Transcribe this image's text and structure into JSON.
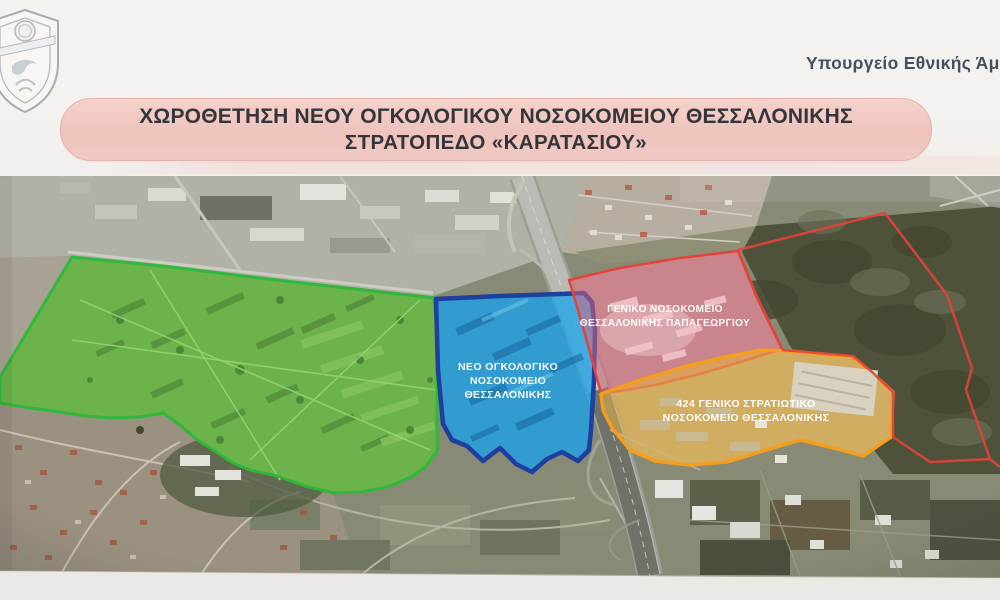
{
  "header": {
    "logo": "hellenic-army-shield-emblem",
    "ministry_label": "Υπουργείο Εθνικής Άμυν",
    "title_line1": "ΧΩΡΟΘΕΤΗΣΗ ΝΕΟΥ ΟΓΚΟΛΟΓΙΚΟΥ ΝΟΣΟΚΟΜΕΙΟΥ ΘΕΣΣΑΛΟΝΙΚΗΣ",
    "title_line2": "ΣΤΡΑΤΟΠΕΔΟ «ΚΑΡΑΤΑΣΙΟΥ»",
    "banner_color": "#f2c9c2",
    "title_text_color": "#34353b",
    "ministry_text_color": "#454f5f"
  },
  "map": {
    "kind": "satellite-photo-with-overlaid-zones",
    "zones": [
      {
        "id": "karatasiou-camp-site",
        "label_lines": [],
        "fill": "#58c23c",
        "stroke": "#2db83a"
      },
      {
        "id": "new-oncology-hospital-site",
        "label_lines": [
          "ΝΕΟ ΟΓΚΟΛΟΓΙΚΟ",
          "ΝΟΣΟΚΟΜΕΙΟ",
          "ΘΕΣΣΑΛΟΝΙΚΗΣ"
        ],
        "fill": "#29a6e5",
        "stroke": "#1e3f9d"
      },
      {
        "id": "papageorgiou-general-hospital",
        "label_lines": [
          "ΓΕΝΙΚΟ ΝΟΣΟΚΟΜΕΙΟ",
          "ΘΕΣΣΑΛΟΝΙΚΗΣ ΠΑΠΑΓΕΩΡΓΙΟΥ"
        ],
        "fill": "#e2647a",
        "stroke": "#e2433c"
      },
      {
        "id": "424-general-military-hospital",
        "label_lines": [
          "424 ΓΕΝΙΚΟ ΣΤΡΑΤΙΩΤΙΚΟ",
          "ΝΟΣΟΚΟΜΕΙΟ ΘΕΣΣΑΛΟΝΙΚΗΣ"
        ],
        "fill": "#e7b44e",
        "stroke": "#f59d1d"
      },
      {
        "id": "outlined-area-northeast",
        "label_lines": [],
        "fill": "none",
        "stroke": "#e2433c"
      }
    ]
  }
}
